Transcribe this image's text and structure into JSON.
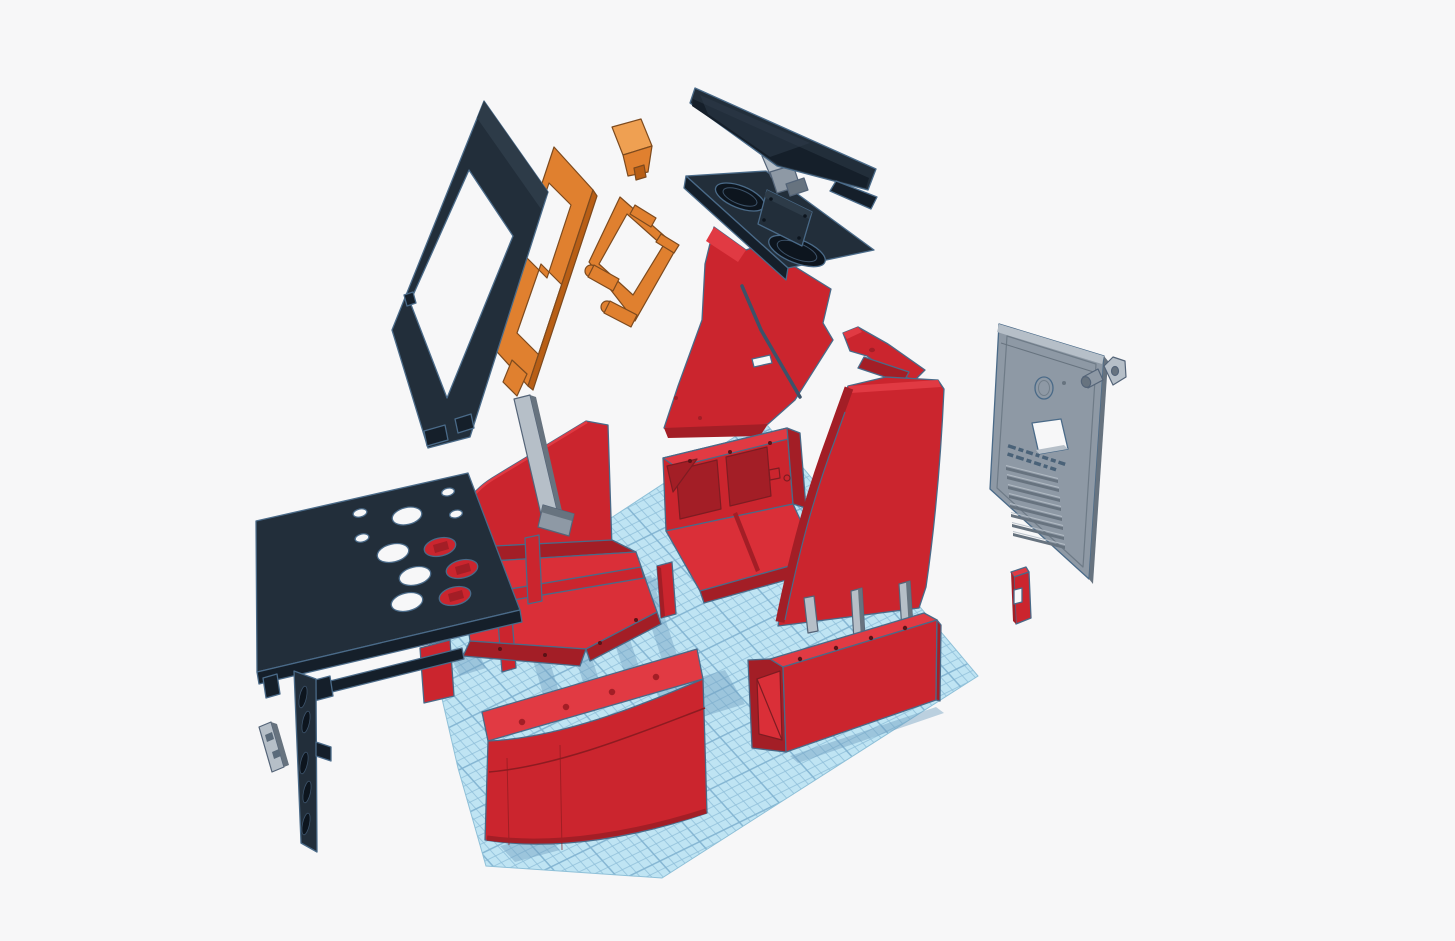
{
  "app": {
    "name": "3D design viewport",
    "description": "Exploded 3D view of a red, black and orange bartop arcade cabinet kit floating above a blue grid workplane"
  },
  "viewport": {
    "width": 1455,
    "height": 941
  },
  "workplane": {
    "grid_minor_px": 8.5,
    "grid_major_px": 42.5
  },
  "palette": {
    "bg": "#f7f7f8",
    "red-face": "#cb252e",
    "red-bright": "#e13a43",
    "red-floor": "#da2f38",
    "red-dark": "#a31e26",
    "red-outline": "#7e1c22",
    "black-face": "#222e3a",
    "black-dark": "#151f2a",
    "black-light": "#2d3b48",
    "steel": "#4a6a88",
    "orange-face": "#e0802f",
    "orange-light": "#efa052",
    "orange-dark": "#b85e15",
    "gray-face": "#8e99a5",
    "gray-light": "#b6bfc8",
    "gray-dark": "#67737f",
    "gray-outline": "#546478",
    "plane-base": "#bfe4f3",
    "plane-line": "#8dbdd8",
    "plane-line-major": "#7fb2d0",
    "plane-edge": "#8fc0d8",
    "shadow": "#729fc2",
    "hole-dark": "#0d151e",
    "emboss": "#4a6278"
  },
  "parts": [
    {
      "id": "screen-bezel",
      "color_key": "black-face",
      "label": "Screen bezel frame"
    },
    {
      "id": "monitor-mount-plate",
      "color_key": "orange-face",
      "label": "Monitor mount plate"
    },
    {
      "id": "monitor-mount-bracket",
      "color_key": "orange-face",
      "label": "Monitor mount bracket"
    },
    {
      "id": "mount-wedge",
      "color_key": "orange-face",
      "label": "Mount wedge block"
    },
    {
      "id": "screen-panel",
      "color_key": "black-face",
      "label": "Screen panel"
    },
    {
      "id": "hinge-block",
      "color_key": "gray-face",
      "label": "Hinge block"
    },
    {
      "id": "speaker-tray",
      "color_key": "black-face",
      "label": "Speaker tray with two speaker rings"
    },
    {
      "id": "monitor-support-panel",
      "color_key": "red-face",
      "label": "Monitor support panel"
    },
    {
      "id": "right-side-panel",
      "color_key": "red-face",
      "label": "Right curved side panel"
    },
    {
      "id": "right-cabinet-shell",
      "color_key": "red-face",
      "label": "Right cabinet shell"
    },
    {
      "id": "left-side-curve",
      "color_key": "red-face",
      "label": "Left curved side piece"
    },
    {
      "id": "left-cabinet-shell",
      "color_key": "red-face",
      "label": "Left cabinet shell"
    },
    {
      "id": "support-rod",
      "color_key": "gray-light",
      "label": "Support rod"
    },
    {
      "id": "control-panel",
      "color_key": "black-face",
      "label": "Control panel with joystick and button holes"
    },
    {
      "id": "vent-strip",
      "color_key": "black-face",
      "label": "Vent strip"
    },
    {
      "id": "mounting-clip",
      "color_key": "gray-light",
      "label": "Mounting clip"
    },
    {
      "id": "front-curved-panel",
      "color_key": "red-face",
      "label": "Front curved panel"
    },
    {
      "id": "kick-panel-box",
      "color_key": "red-face",
      "label": "Kick panel box"
    },
    {
      "id": "alignment-pegs",
      "color_key": "gray-light",
      "label": "Alignment pegs"
    },
    {
      "id": "red-stake",
      "color_key": "red-face",
      "label": "Small red stake"
    },
    {
      "id": "back-door-panel",
      "color_key": "gray-face",
      "label": "Vented back door panel"
    },
    {
      "id": "lock-barrel",
      "color_key": "gray-face",
      "label": "Lock barrel"
    },
    {
      "id": "lock-plate",
      "color_key": "gray-face",
      "label": "Lock plate"
    },
    {
      "id": "small-red-bracket",
      "color_key": "red-face",
      "label": "Small red bracket"
    }
  ]
}
